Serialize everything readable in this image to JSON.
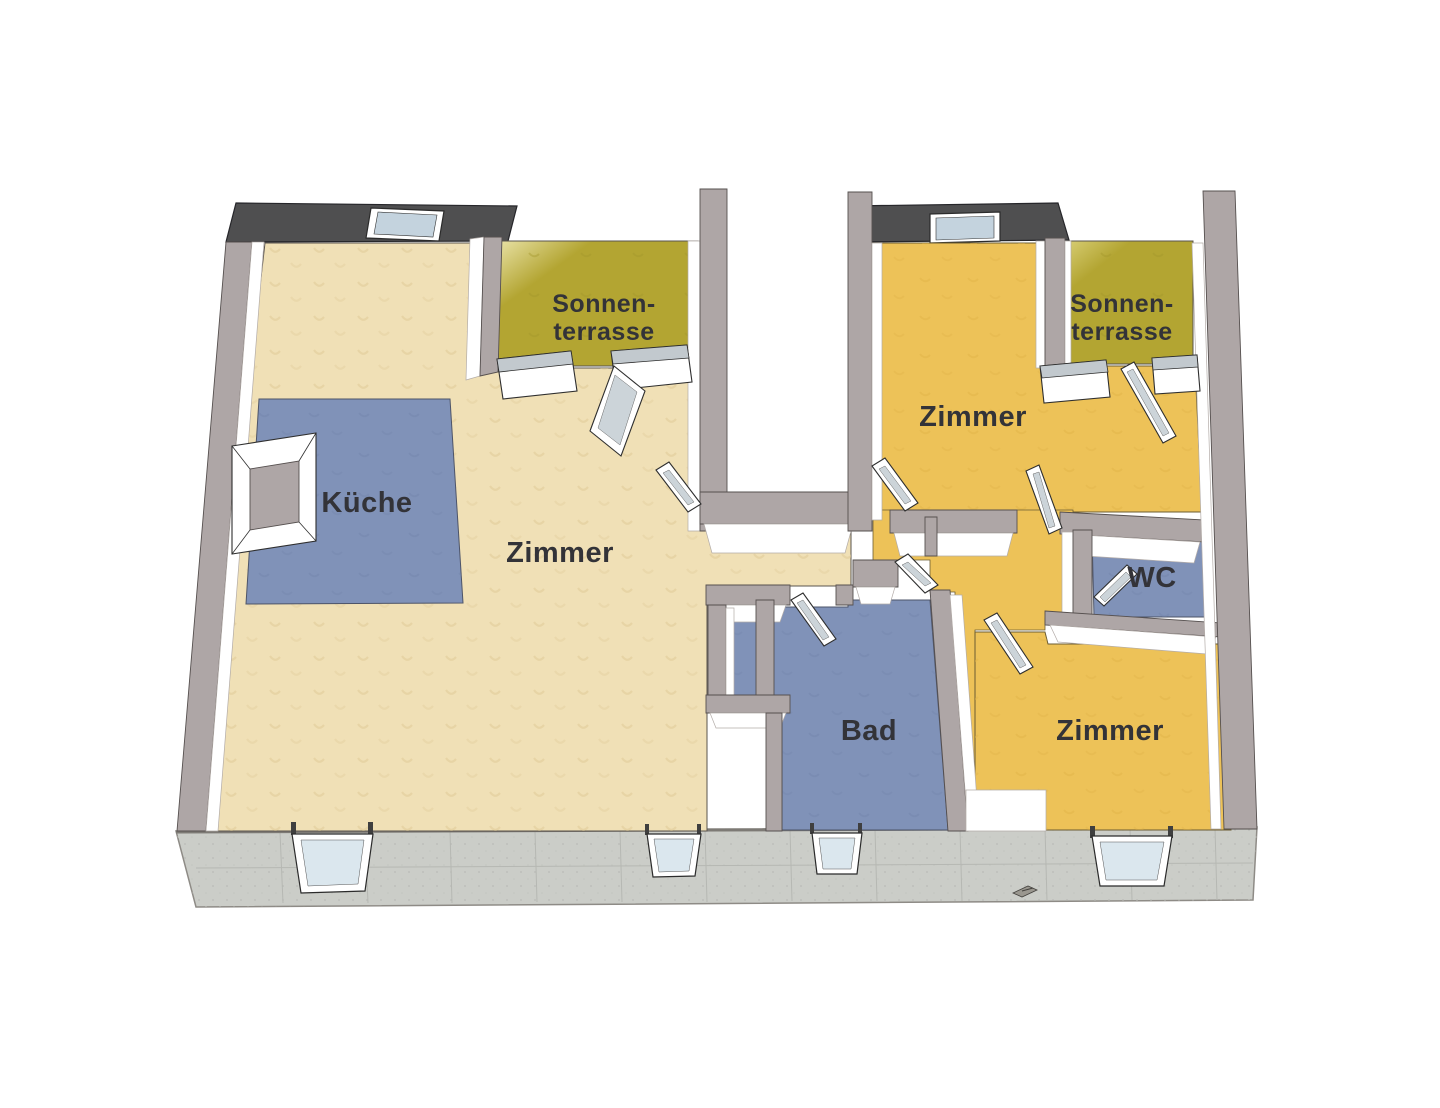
{
  "floorplan": {
    "language": "de",
    "rooms": [
      {
        "id": "sonnenterrasse-links",
        "label": "Sonnen-terrasse",
        "label_lines": [
          "Sonnen-",
          "terrasse"
        ],
        "type": "terrace",
        "floor_color": "#b3a532"
      },
      {
        "id": "kueche",
        "label": "Küche",
        "type": "kitchen",
        "floor_color": "#8092b8"
      },
      {
        "id": "zimmer-links",
        "label": "Zimmer",
        "type": "room",
        "floor_color": "#f0e0b6"
      },
      {
        "id": "zimmer-oben-rechts",
        "label": "Zimmer",
        "type": "room",
        "floor_color": "#edc258"
      },
      {
        "id": "sonnenterrasse-rechts",
        "label": "Sonnen-terrasse",
        "label_lines": [
          "Sonnen-",
          "terrasse"
        ],
        "type": "terrace",
        "floor_color": "#b3a532"
      },
      {
        "id": "wc",
        "label": "WC",
        "type": "wc",
        "floor_color": "#8092b8"
      },
      {
        "id": "bad",
        "label": "Bad",
        "type": "bathroom",
        "floor_color": "#8092b8"
      },
      {
        "id": "zimmer-unten-rechts",
        "label": "Zimmer",
        "type": "room",
        "floor_color": "#edc258"
      }
    ],
    "colors": {
      "background": "#ffffff",
      "wall": "#aea6a6",
      "wall_face": "#ffffff",
      "roof": "#4f4f50",
      "skylight_glass": "#c4d3de",
      "foundation": "#cbcdc8",
      "window_glass": "#dbe7ee",
      "door_glass": "#ccd4d9",
      "floor_beige": "#f0e0b6",
      "floor_amber": "#edc258",
      "floor_terrace": "#b3a532",
      "floor_blue": "#8092b8",
      "label_text": "#333338"
    },
    "features": {
      "view": "3d-floor-plan",
      "roof_sections": 2,
      "skylights": 2,
      "basement_windows": 4,
      "open_doors": 9,
      "terrace_door_units": 4,
      "ground_marker": true
    }
  }
}
